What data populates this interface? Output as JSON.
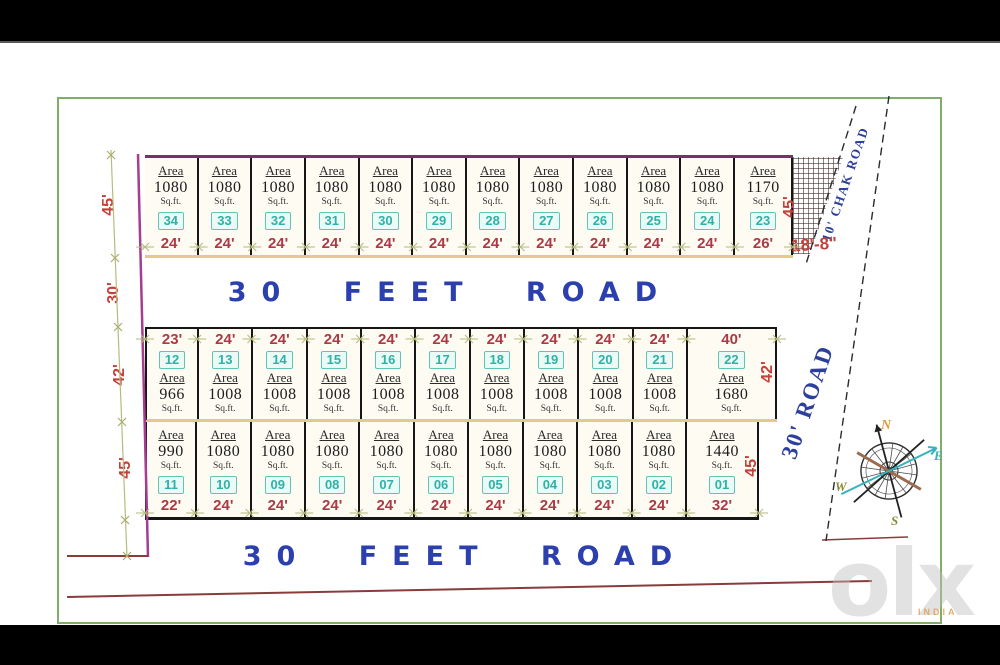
{
  "roads": {
    "middle": "30 FEET ROAD",
    "bottom": "30 FEET ROAD",
    "chak": "10' CHAK ROAD",
    "side": "30' ROAD"
  },
  "labels": {
    "area_word": "Area",
    "sqft": "Sq.ft."
  },
  "dimensions": {
    "left": [
      "45'",
      "30'",
      "42'",
      "45'"
    ],
    "right_top": "45'",
    "right_mid": "42'",
    "right_bot": "45'",
    "hatch": "18'-8\""
  },
  "rows": [
    {
      "id": "top",
      "label_pos": "bottom",
      "plots": [
        {
          "no": "34",
          "area": "1080",
          "width": "24'"
        },
        {
          "no": "33",
          "area": "1080",
          "width": "24'"
        },
        {
          "no": "32",
          "area": "1080",
          "width": "24'"
        },
        {
          "no": "31",
          "area": "1080",
          "width": "24'"
        },
        {
          "no": "30",
          "area": "1080",
          "width": "24'"
        },
        {
          "no": "29",
          "area": "1080",
          "width": "24'"
        },
        {
          "no": "28",
          "area": "1080",
          "width": "24'"
        },
        {
          "no": "27",
          "area": "1080",
          "width": "24'"
        },
        {
          "no": "26",
          "area": "1080",
          "width": "24'"
        },
        {
          "no": "25",
          "area": "1080",
          "width": "24'"
        },
        {
          "no": "24",
          "area": "1080",
          "width": "24'"
        },
        {
          "no": "23",
          "area": "1170",
          "width": "26'"
        }
      ]
    },
    {
      "id": "middle",
      "label_pos": "top",
      "plots": [
        {
          "no": "12",
          "area": "966",
          "width": "23'"
        },
        {
          "no": "13",
          "area": "1008",
          "width": "24'"
        },
        {
          "no": "14",
          "area": "1008",
          "width": "24'"
        },
        {
          "no": "15",
          "area": "1008",
          "width": "24'"
        },
        {
          "no": "16",
          "area": "1008",
          "width": "24'"
        },
        {
          "no": "17",
          "area": "1008",
          "width": "24'"
        },
        {
          "no": "18",
          "area": "1008",
          "width": "24'"
        },
        {
          "no": "19",
          "area": "1008",
          "width": "24'"
        },
        {
          "no": "20",
          "area": "1008",
          "width": "24'"
        },
        {
          "no": "21",
          "area": "1008",
          "width": "24'"
        },
        {
          "no": "22",
          "area": "1680",
          "width": "40'"
        }
      ]
    },
    {
      "id": "bottom",
      "label_pos": "bottom",
      "plots": [
        {
          "no": "11",
          "area": "990",
          "width": "22'"
        },
        {
          "no": "10",
          "area": "1080",
          "width": "24'"
        },
        {
          "no": "09",
          "area": "1080",
          "width": "24'"
        },
        {
          "no": "08",
          "area": "1080",
          "width": "24'"
        },
        {
          "no": "07",
          "area": "1080",
          "width": "24'"
        },
        {
          "no": "06",
          "area": "1080",
          "width": "24'"
        },
        {
          "no": "05",
          "area": "1080",
          "width": "24'"
        },
        {
          "no": "04",
          "area": "1080",
          "width": "24'"
        },
        {
          "no": "03",
          "area": "1080",
          "width": "24'"
        },
        {
          "no": "02",
          "area": "1080",
          "width": "24'"
        },
        {
          "no": "01",
          "area": "1440",
          "width": "32'"
        }
      ]
    },
    null
  ],
  "compass": {
    "n": "N",
    "e": "E",
    "s": "S",
    "w": "W"
  },
  "watermark": {
    "logo": "olx",
    "sub": "INDIA"
  }
}
